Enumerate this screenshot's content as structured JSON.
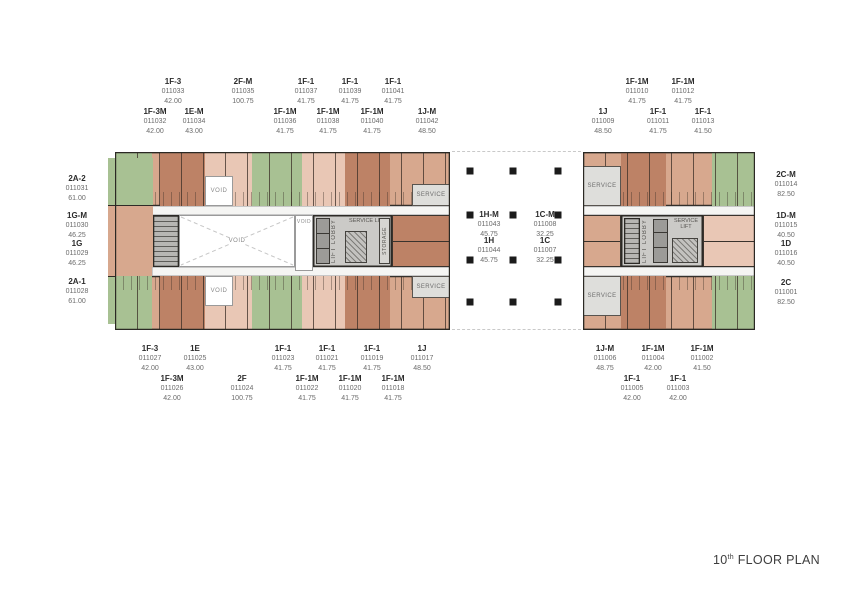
{
  "title": {
    "number": "10",
    "ordinal": "th",
    "rest": " FLOOR PLAN"
  },
  "plan_texts": {
    "void": "VOID",
    "lift_lobby": "LIFT LOBBY",
    "service_lift": "SERVICE LIFT",
    "service": "SERVICE",
    "storage": "STORAGE"
  },
  "colors": {
    "unit_dark": "#bd8266",
    "unit_med": "#d7a88e",
    "unit_light": "#e9c7b5",
    "green": "#a8c193",
    "service_gray": "#dededb",
    "core_gray": "#cbcac7",
    "column_black": "#1b1b1b"
  },
  "unit_labels": [
    {
      "group": "top-left",
      "name": "1F-3",
      "no": "011033",
      "area": "42.00",
      "x": 173,
      "y": 77
    },
    {
      "group": "top-left",
      "name": "2F-M",
      "no": "011035",
      "area": "100.75",
      "x": 243,
      "y": 77
    },
    {
      "group": "top-left",
      "name": "1F-1",
      "no": "011037",
      "area": "41.75",
      "x": 306,
      "y": 77
    },
    {
      "group": "top-left",
      "name": "1F-1",
      "no": "011039",
      "area": "41.75",
      "x": 350,
      "y": 77
    },
    {
      "group": "top-left",
      "name": "1F-1",
      "no": "011041",
      "area": "41.75",
      "x": 393,
      "y": 77
    },
    {
      "group": "top-left",
      "name": "1F-3M",
      "no": "011032",
      "area": "42.00",
      "x": 155,
      "y": 107
    },
    {
      "group": "top-left",
      "name": "1E-M",
      "no": "011034",
      "area": "43.00",
      "x": 194,
      "y": 107
    },
    {
      "group": "top-left",
      "name": "1F-1M",
      "no": "011036",
      "area": "41.75",
      "x": 285,
      "y": 107
    },
    {
      "group": "top-left",
      "name": "1F-1M",
      "no": "011038",
      "area": "41.75",
      "x": 328,
      "y": 107
    },
    {
      "group": "top-left",
      "name": "1F-1M",
      "no": "011040",
      "area": "41.75",
      "x": 372,
      "y": 107
    },
    {
      "group": "top-left",
      "name": "1J-M",
      "no": "011042",
      "area": "48.50",
      "x": 427,
      "y": 107
    },
    {
      "group": "top-right",
      "name": "1F-1M",
      "no": "011010",
      "area": "41.75",
      "x": 637,
      "y": 77
    },
    {
      "group": "top-right",
      "name": "1F-1M",
      "no": "011012",
      "area": "41.75",
      "x": 683,
      "y": 77
    },
    {
      "group": "top-right",
      "name": "1J",
      "no": "011009",
      "area": "48.50",
      "x": 603,
      "y": 107
    },
    {
      "group": "top-right",
      "name": "1F-1",
      "no": "011011",
      "area": "41.75",
      "x": 658,
      "y": 107
    },
    {
      "group": "top-right",
      "name": "1F-1",
      "no": "011013",
      "area": "41.50",
      "x": 703,
      "y": 107
    },
    {
      "group": "left-side",
      "name": "2A-2",
      "no": "011031",
      "area": "61.00",
      "x": 77,
      "y": 174
    },
    {
      "group": "left-side",
      "name": "1G-M",
      "no": "011030",
      "area": "46.25",
      "x": 77,
      "y": 211
    },
    {
      "group": "left-side",
      "name": "1G",
      "no": "011029",
      "area": "46.25",
      "x": 77,
      "y": 239
    },
    {
      "group": "left-side",
      "name": "2A-1",
      "no": "011028",
      "area": "61.00",
      "x": 77,
      "y": 277
    },
    {
      "group": "right-side",
      "name": "2C-M",
      "no": "011014",
      "area": "82.50",
      "x": 786,
      "y": 170
    },
    {
      "group": "right-side",
      "name": "1D-M",
      "no": "011015",
      "area": "40.50",
      "x": 786,
      "y": 211
    },
    {
      "group": "right-side",
      "name": "1D",
      "no": "011016",
      "area": "40.50",
      "x": 786,
      "y": 239
    },
    {
      "group": "right-side",
      "name": "2C",
      "no": "011001",
      "area": "82.50",
      "x": 786,
      "y": 278
    },
    {
      "group": "center",
      "name": "1H-M",
      "no": "011043",
      "area": "45.75",
      "x": 489,
      "y": 210
    },
    {
      "group": "center",
      "name": "1C-M",
      "no": "011008",
      "area": "32.25",
      "x": 545,
      "y": 210
    },
    {
      "group": "center",
      "name": "1H",
      "no": "011044",
      "area": "45.75",
      "x": 489,
      "y": 236
    },
    {
      "group": "center",
      "name": "1C",
      "no": "011007",
      "area": "32.25",
      "x": 545,
      "y": 236
    },
    {
      "group": "bottom-left",
      "name": "1F-3",
      "no": "011027",
      "area": "42.00",
      "x": 150,
      "y": 344
    },
    {
      "group": "bottom-left",
      "name": "1E",
      "no": "011025",
      "area": "43.00",
      "x": 195,
      "y": 344
    },
    {
      "group": "bottom-left",
      "name": "1F-1",
      "no": "011023",
      "area": "41.75",
      "x": 283,
      "y": 344
    },
    {
      "group": "bottom-left",
      "name": "1F-1",
      "no": "011021",
      "area": "41.75",
      "x": 327,
      "y": 344
    },
    {
      "group": "bottom-left",
      "name": "1F-1",
      "no": "011019",
      "area": "41.75",
      "x": 372,
      "y": 344
    },
    {
      "group": "bottom-left",
      "name": "1J",
      "no": "011017",
      "area": "48.50",
      "x": 422,
      "y": 344
    },
    {
      "group": "bottom-left",
      "name": "1F-3M",
      "no": "011026",
      "area": "42.00",
      "x": 172,
      "y": 374
    },
    {
      "group": "bottom-left",
      "name": "2F",
      "no": "011024",
      "area": "100.75",
      "x": 242,
      "y": 374
    },
    {
      "group": "bottom-left",
      "name": "1F-1M",
      "no": "011022",
      "area": "41.75",
      "x": 307,
      "y": 374
    },
    {
      "group": "bottom-left",
      "name": "1F-1M",
      "no": "011020",
      "area": "41.75",
      "x": 350,
      "y": 374
    },
    {
      "group": "bottom-left",
      "name": "1F-1M",
      "no": "011018",
      "area": "41.75",
      "x": 393,
      "y": 374
    },
    {
      "group": "bottom-right",
      "name": "1J-M",
      "no": "011006",
      "area": "48.75",
      "x": 605,
      "y": 344
    },
    {
      "group": "bottom-right",
      "name": "1F-1M",
      "no": "011004",
      "area": "42.00",
      "x": 653,
      "y": 344
    },
    {
      "group": "bottom-right",
      "name": "1F-1M",
      "no": "011002",
      "area": "41.50",
      "x": 702,
      "y": 344
    },
    {
      "group": "bottom-right",
      "name": "1F-1",
      "no": "011005",
      "area": "42.00",
      "x": 632,
      "y": 374
    },
    {
      "group": "bottom-right",
      "name": "1F-1",
      "no": "011003",
      "area": "42.00",
      "x": 678,
      "y": 374
    }
  ],
  "columns": [
    {
      "x": 470,
      "y": 171
    },
    {
      "x": 513,
      "y": 171
    },
    {
      "x": 558,
      "y": 171
    },
    {
      "x": 470,
      "y": 215
    },
    {
      "x": 513,
      "y": 215
    },
    {
      "x": 558,
      "y": 215
    },
    {
      "x": 470,
      "y": 260
    },
    {
      "x": 513,
      "y": 260
    },
    {
      "x": 558,
      "y": 260
    },
    {
      "x": 470,
      "y": 302
    },
    {
      "x": 513,
      "y": 302
    },
    {
      "x": 558,
      "y": 302
    }
  ]
}
